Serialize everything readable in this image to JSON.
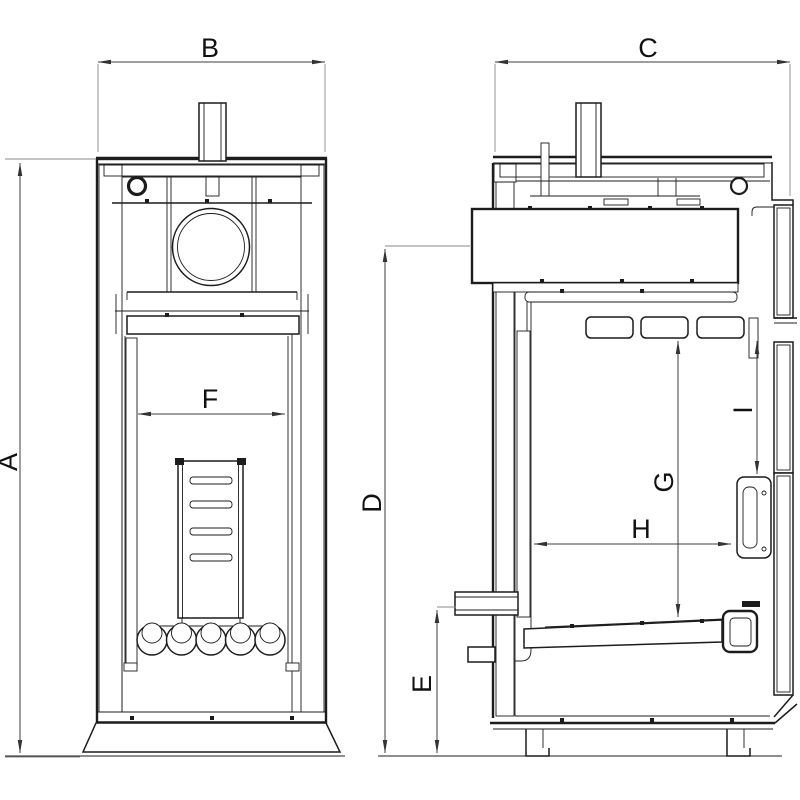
{
  "page": {
    "background": "#ffffff",
    "line_color": "#1c1c1c",
    "dimension_line_color": "#3d3d3d"
  },
  "drawing": {
    "views": [
      {
        "id": "front-section",
        "position": "left"
      },
      {
        "id": "side-section",
        "position": "right"
      }
    ],
    "dimensions": {
      "A": {
        "label": "A"
      },
      "B": {
        "label": "B"
      },
      "C": {
        "label": "C"
      },
      "D": {
        "label": "D"
      },
      "E": {
        "label": "E"
      },
      "F": {
        "label": "F"
      },
      "G": {
        "label": "G"
      },
      "H": {
        "label": "H"
      },
      "I": {
        "label": "I"
      }
    }
  }
}
